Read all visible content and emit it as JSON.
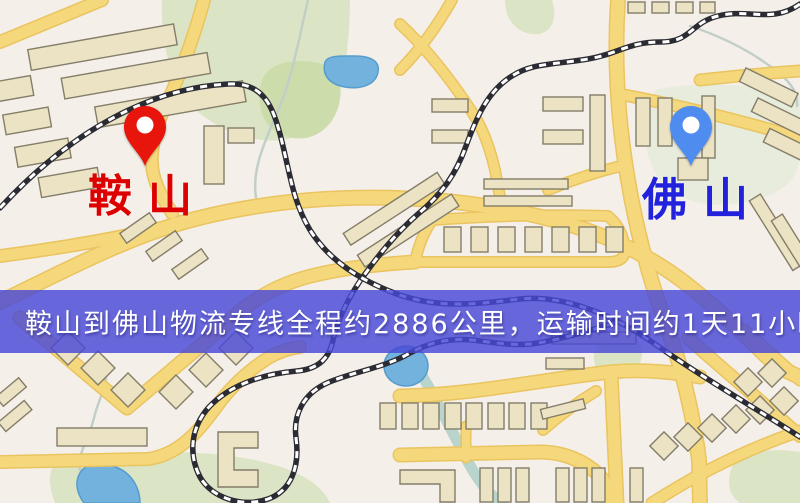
{
  "banner": {
    "text": "鞍山到佛山物流专线全程约2886公里，运输时间约1天11小时.",
    "background_color": "rgba(72,72,215,0.82)",
    "text_color": "#ffffff"
  },
  "map": {
    "markers": [
      {
        "id": "origin",
        "label": "鞍山",
        "pin_color": "#e8150d",
        "label_color": "#dd0000"
      },
      {
        "id": "destination",
        "label": "佛山",
        "pin_color": "#4e8cf0",
        "label_color": "#2222dd"
      }
    ]
  },
  "palette": {
    "map_background": "#f5efe9",
    "road_fill": "#f6d87c",
    "road_casing": "#e9c45f",
    "building_fill": "#ece3c4",
    "building_stroke": "#837d69",
    "park_green": "#dbe5c6",
    "park_green_dark": "#cddcab",
    "water_blue": "#74b2de",
    "railway_dark": "#2b2b33",
    "railway_light": "#ffffff"
  }
}
